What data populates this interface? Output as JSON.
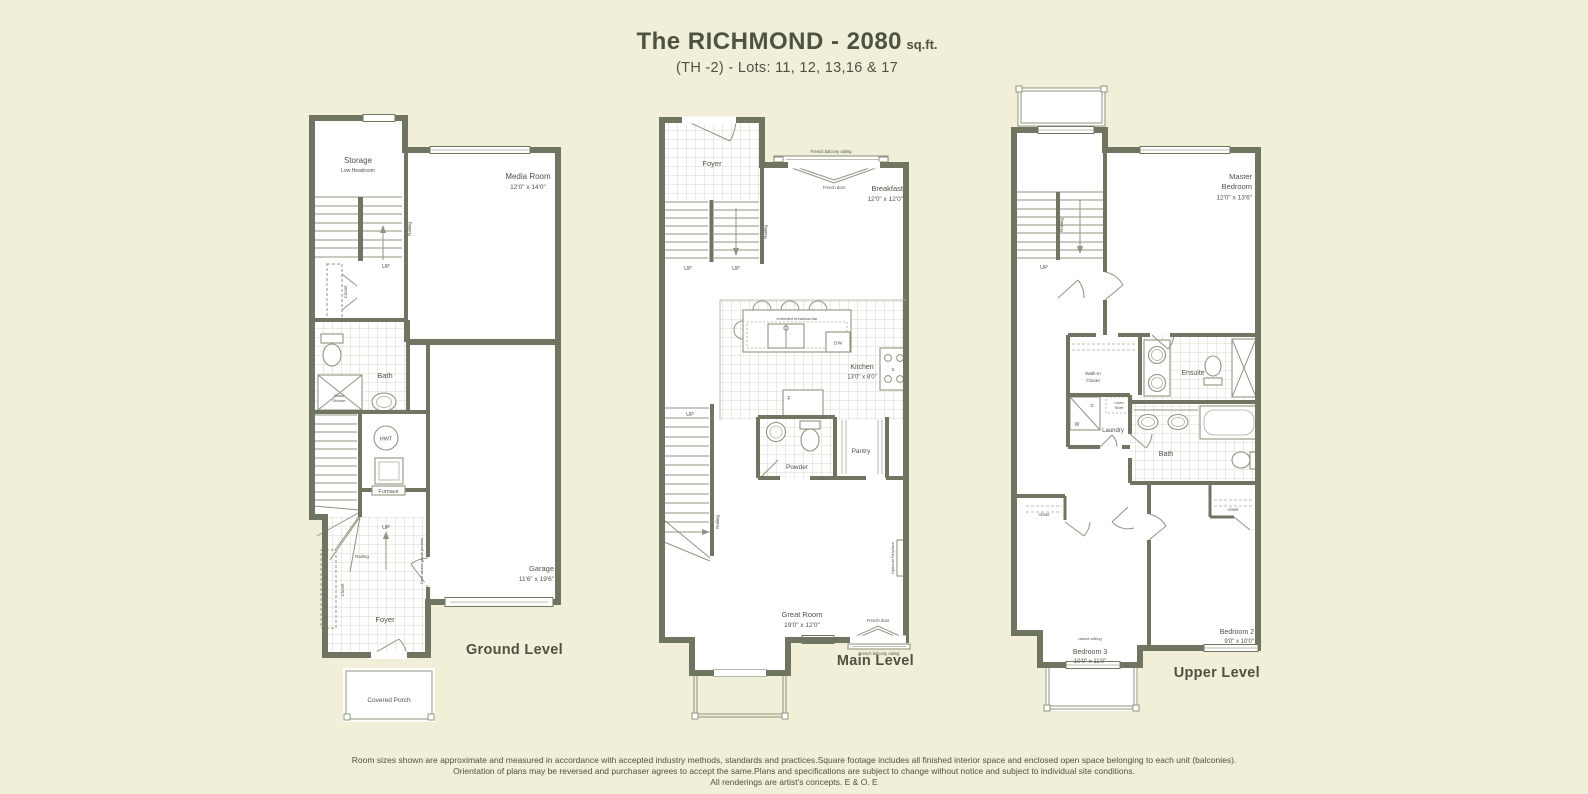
{
  "title": {
    "main": "The RICHMOND - 2080",
    "unit": "sq.ft.",
    "subtitle": "(TH -2) - Lots: 11, 12, 13,16 & 17"
  },
  "colors": {
    "background": "#f2efd8",
    "wall": "#6f7561",
    "text": "#4f5447",
    "caption": "#4d5340"
  },
  "ground": {
    "caption": "Ground Level",
    "storage": "Storage",
    "storage_note": "Low Headroom",
    "media_room": "Media Room",
    "media_room_dims": "12'0\" x 14'0\"",
    "bath": "Bath",
    "glass1": "Glass",
    "glass2": "Shower",
    "hwt": "HWT",
    "furnace": "Furnace",
    "garage": "Garage",
    "garage_dims": "11'6\" x 19'6\"",
    "foyer": "Foyer",
    "covered_porch": "Covered Porch",
    "closet_upper": "Closet",
    "closet_lower": "Closet",
    "railing_upper": "Railing",
    "railing_lower": "Railing",
    "up_upper": "UP",
    "up_lower": "UP",
    "door_note": "Door where grade permits"
  },
  "main_floor": {
    "caption": "Main Level",
    "foyer": "Foyer",
    "up_a": "UP",
    "up_b": "UP",
    "up_c": "UP",
    "railing_a": "Railing",
    "railing_b": "Railing",
    "french_balcony_railing_top": "French balcony railing",
    "french_door_top": "French door",
    "breakfast": "Breakfast",
    "breakfast_dims": "12'0\" x 12'0\"",
    "extended_breakfast_bar": "extended breakfast bar",
    "dw": "DW",
    "stove": "S",
    "fridge": "F",
    "kitchen": "Kitchen",
    "kitchen_dims": "13'0\" x 8'0\"",
    "powder": "Powder",
    "pantry": "Pantry",
    "great_room": "Great Room",
    "great_room_dims": "19'0\" x 12'0\"",
    "optional_fireplace": "Optional Fireplace",
    "french_door_bottom": "French door",
    "french_balcony_railing_bottom": "French balcony railing"
  },
  "upper": {
    "caption": "Upper Level",
    "up": "UP",
    "railing": "Railing",
    "master1": "Master",
    "master2": "Bedroom",
    "master_dims": "12'0\" x 13'6\"",
    "walk_in1": "Walk-in",
    "walk_in2": "Closet",
    "ensuite": "Ensuite",
    "laundry": "Laundry",
    "washer": "W",
    "dryer": "D",
    "linen1": "Linen",
    "linen2": "Shelf",
    "bath": "Bath",
    "bedroom2": "Bedroom 2",
    "bedroom2_dims": "9'0\" x 10'0\"",
    "bedroom3": "Bedroom 3",
    "bedroom3_dims": "10'0\" x 11'0\"",
    "raised_ceiling": "raised ceiling",
    "closet_b3": "closet",
    "closet_b2": "closet"
  },
  "footer": {
    "line1": "Room sizes shown are approximate and measured in accordance with accepted industry methods, standards and practices.Square footage includes all finished interior space and enclosed open space belonging to each unit (balconies).",
    "line2": "Orientation of plans may be reversed and purchaser agrees to accept the same.Plans and specifications are subject to change without notice and subject to individual site conditions.",
    "line3": "All renderings are artist's concepts.   E & O. E"
  }
}
